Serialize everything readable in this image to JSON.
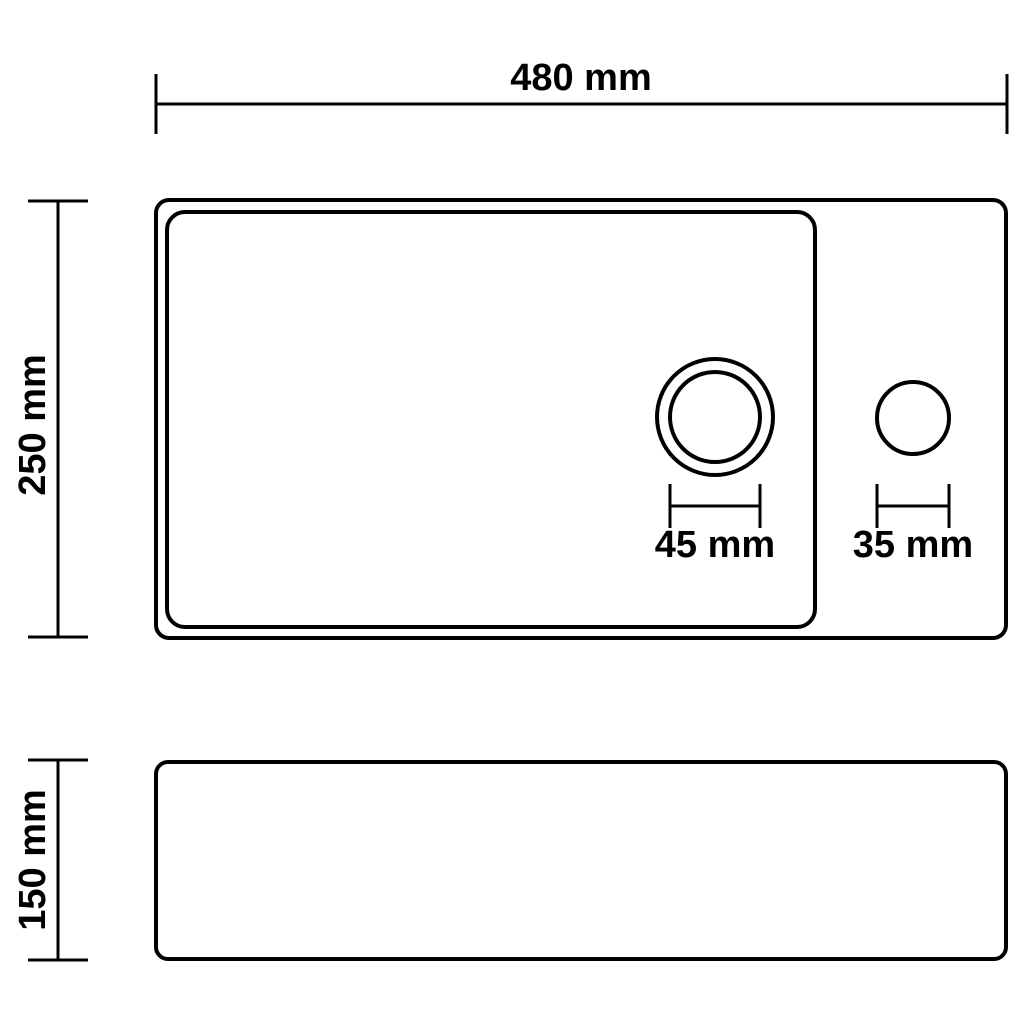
{
  "drawing": {
    "background_color": "#ffffff",
    "line_color": "#000000"
  },
  "dimensions": {
    "overall_width": {
      "label": "480 mm",
      "value": 480,
      "unit": "mm"
    },
    "overall_depth": {
      "label": "250 mm",
      "value": 250,
      "unit": "mm"
    },
    "overall_height": {
      "label": "150 mm",
      "value": 150,
      "unit": "mm"
    },
    "drain_hole_diameter": {
      "label": "45 mm",
      "value": 45,
      "unit": "mm"
    },
    "tap_hole_diameter": {
      "label": "35 mm",
      "value": 35,
      "unit": "mm"
    }
  }
}
